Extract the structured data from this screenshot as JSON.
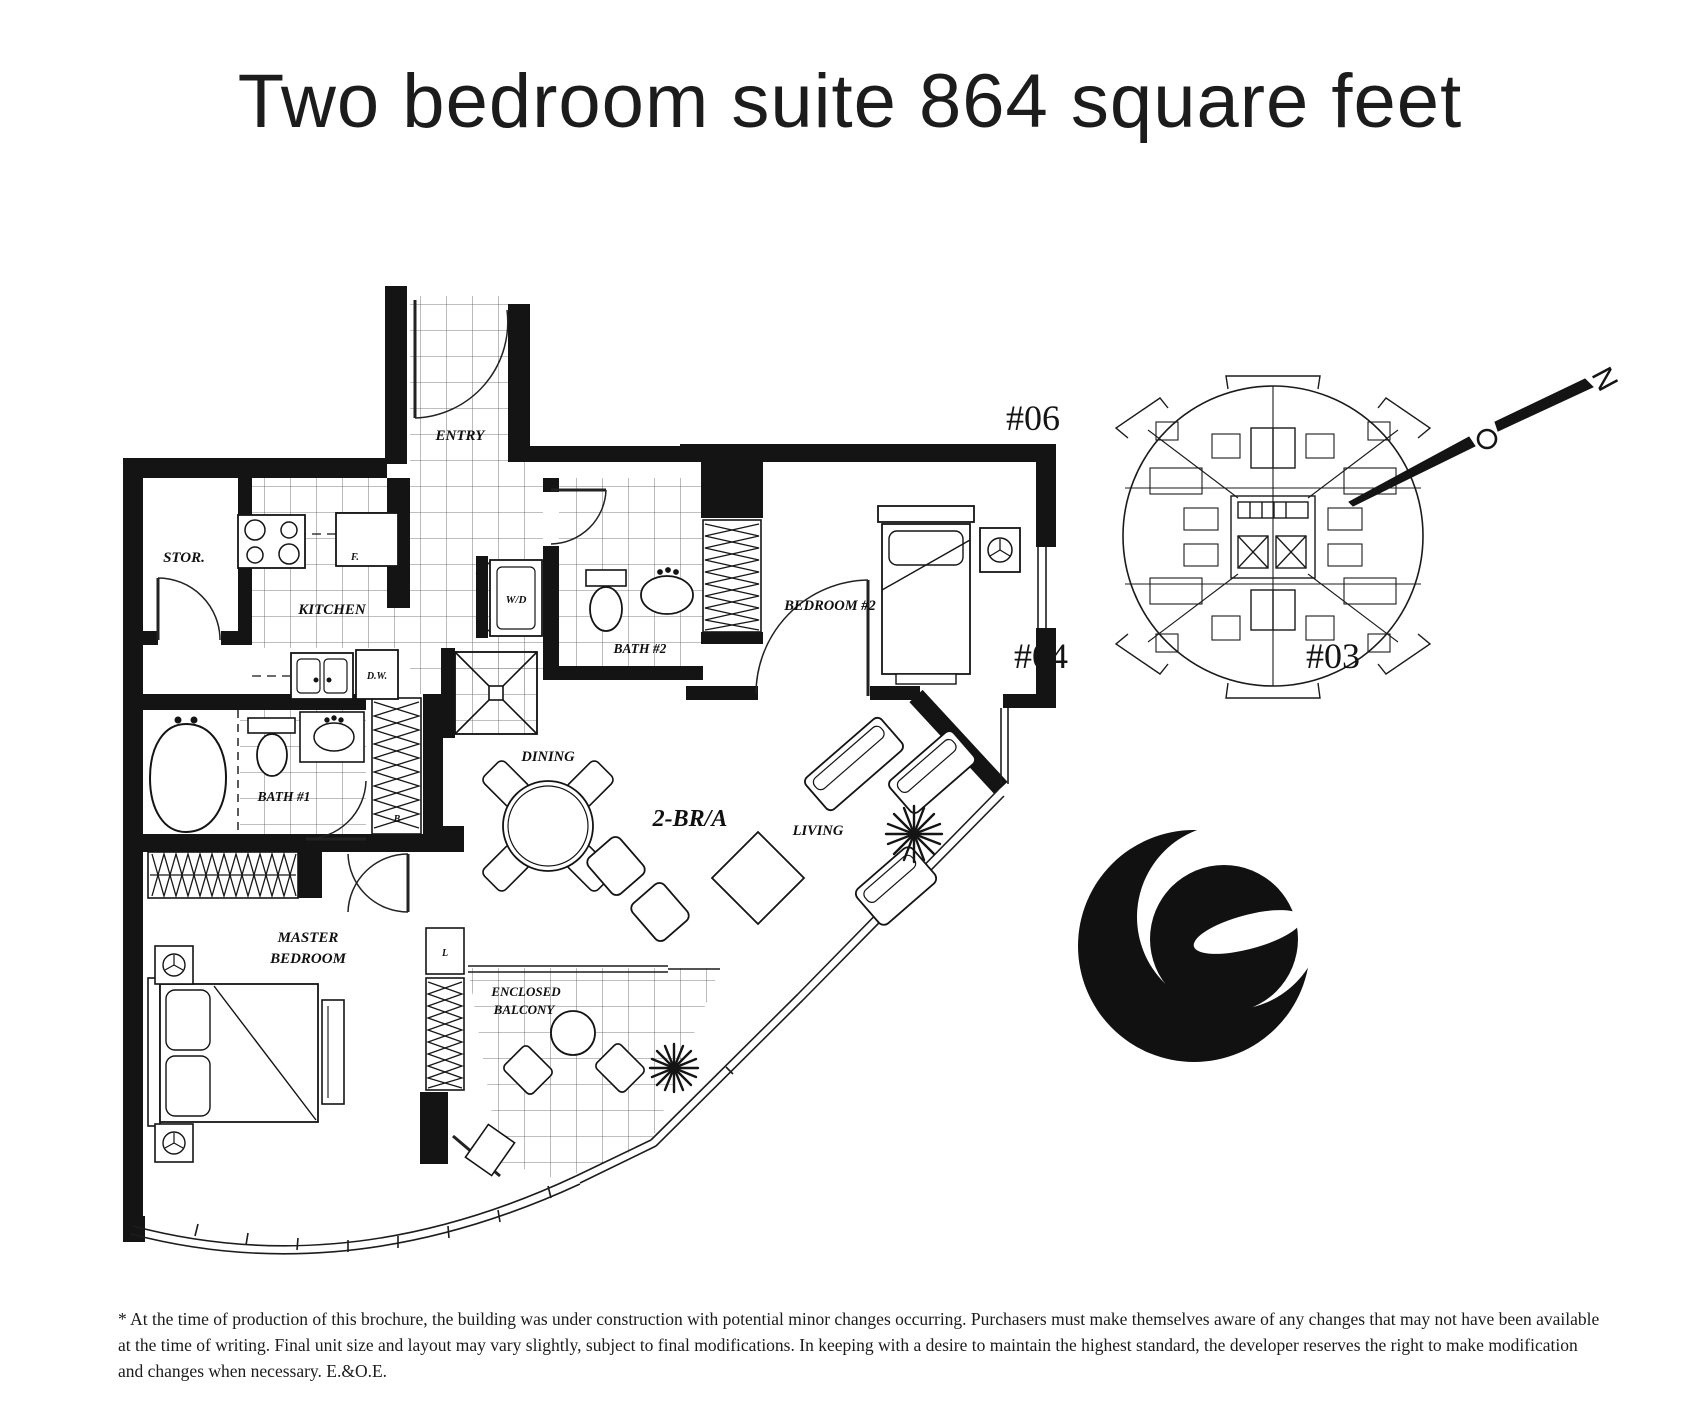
{
  "title": "Two bedroom suite 864 square feet",
  "plan": {
    "unit_label": "2-BR/A",
    "labels": {
      "entry": "ENTRY",
      "storage": "STOR.",
      "kitchen": "KITCHEN",
      "fridge": "F.",
      "dishwasher": "D.W.",
      "washer_dryer": "W/D",
      "bath2": "BATH #2",
      "bedroom2": "BEDROOM #2",
      "bath1": "BATH #1",
      "broom_closet": "B",
      "linen_closet": "L",
      "dining": "DINING",
      "living": "LIVING",
      "master_line1": "MASTER",
      "master_line2": "BEDROOM",
      "balcony_line1": "ENCLOSED",
      "balcony_line2": "BALCONY"
    }
  },
  "key_plan": {
    "unit_06": "#06",
    "unit_04": "#04",
    "unit_03": "#03"
  },
  "compass": {
    "north_label": "N"
  },
  "disclaimer": {
    "line1": "* At the time of production of this brochure, the building was under construction with potential minor changes occurring. Purchasers must make themselves aware of any changes that may not have been available",
    "line2": "at the time of writing. Final unit size and layout may vary slightly, subject to final modifications. In keeping with a desire to maintain the highest standard, the developer reserves the right to make modification",
    "line3": "and changes when necessary. E.&O.E."
  },
  "colors": {
    "ink": "#141414",
    "paper": "#ffffff"
  }
}
